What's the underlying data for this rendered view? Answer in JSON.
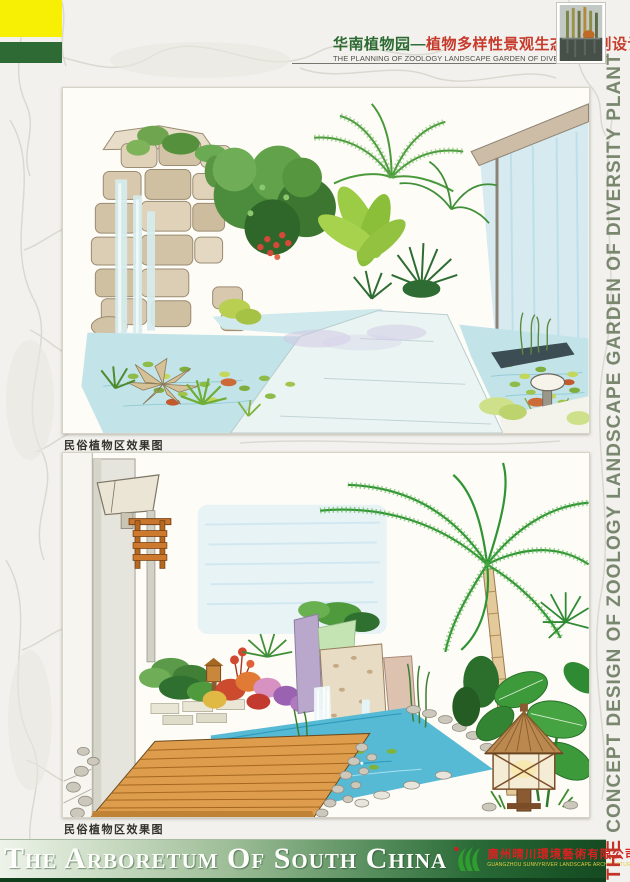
{
  "header": {
    "title_zh_green": "华南植物园—",
    "title_zh_red": "植物多样性景观生态园规划设计",
    "subtitle_en": "THE PLANNING OF ZOOLOGY LANDSCAPE GARDEN OF DIVERSITY PLANT"
  },
  "side_title": {
    "the": "THE",
    "rest": " CONCEPT DESIGN OF ZOOLOGY LANDSCAPE GARDEN OF DIVERSITY PLANT"
  },
  "panels": [
    {
      "caption": "民俗植物区效果图"
    },
    {
      "caption": "民俗植物区效果图"
    }
  ],
  "footer": {
    "title": "The Arboretum Of South China",
    "company_zh": "廣州晴川環境藝術有限公司",
    "company_en": "GUANGZHOU SUNNYRIVER LANDSCAPE ARCHITECTURE ART CO.LTD"
  },
  "colors": {
    "corner_yellow": "#f7ef04",
    "corner_green": "#2d6a34",
    "header_title_green": "#2e6b33",
    "header_title_red": "#c63b2c",
    "side_text_green": "#79876f",
    "side_the_red": "#c23328",
    "banner_dark_green": "#164a22",
    "company_red": "#d82222",
    "company_en_yellow": "#e3cf3e"
  }
}
